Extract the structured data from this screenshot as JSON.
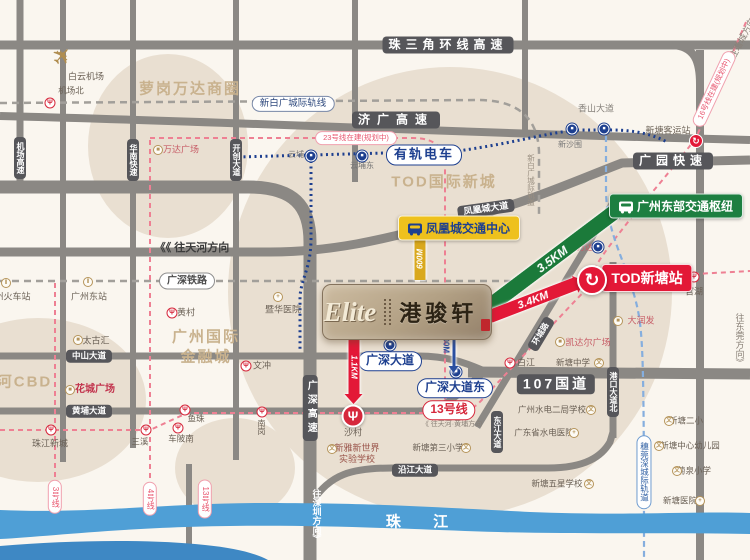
{
  "map": {
    "logo": {
      "en": "Elite",
      "cn": "港骏轩"
    },
    "river": {
      "label": "珠 江"
    },
    "zones": [
      {
        "n": "zone-luogang-wanda",
        "text": "萝岗万达商圈",
        "x": 190,
        "y": 89
      },
      {
        "n": "zone-tod-intl-newtown",
        "text": "TOD国际新城",
        "x": 444,
        "y": 182
      },
      {
        "n": "zone-gz-intl-finance-city",
        "text": "广州国际\n金融城",
        "x": 206,
        "y": 347
      },
      {
        "n": "zone-tianhe-cbd",
        "text": "天河CBD",
        "x": 16,
        "y": 382
      }
    ],
    "road_labels": [
      {
        "n": "road-zhusanjiao-ring-expwy",
        "text": "珠三角环线高速",
        "x": 448,
        "y": 45,
        "fs": 12,
        "ls": 5
      },
      {
        "n": "road-jiguang-expwy",
        "text": "济广高速",
        "x": 396,
        "y": 120,
        "fs": 12,
        "ls": 7
      },
      {
        "n": "road-guangyuan-expwy",
        "text": "广园快速",
        "x": 673,
        "y": 161,
        "fs": 12,
        "ls": 5
      },
      {
        "n": "road-g107",
        "text": "107国道",
        "x": 556,
        "y": 384,
        "fs": 14,
        "ls": 3
      },
      {
        "n": "road-fenghuangcheng-ave",
        "text": "凤凰城大道",
        "x": 486,
        "y": 209,
        "fs": 9,
        "rot": -8
      },
      {
        "n": "road-zhongshan-ave",
        "text": "中山大道",
        "x": 89,
        "y": 356,
        "fs": 8.5
      },
      {
        "n": "road-huangpu-ave",
        "text": "黄埔大道",
        "x": 89,
        "y": 411,
        "fs": 8.5
      },
      {
        "n": "road-yanjiang-ave",
        "text": "沿江大道",
        "x": 415,
        "y": 470,
        "fs": 8.5
      },
      {
        "n": "road-dongjiang-ave",
        "text": "东江大道",
        "x": 497,
        "y": 432,
        "fs": 8,
        "vert": 1
      },
      {
        "n": "road-gangkou-ave-north",
        "text": "港口大道北",
        "x": 613,
        "y": 392,
        "fs": 8,
        "vert": 1
      },
      {
        "n": "road-jichang-expwy",
        "text": "机场高速",
        "x": 20,
        "y": 158,
        "fs": 8,
        "vert": 1
      },
      {
        "n": "road-huanan-expwy",
        "text": "华南快速",
        "x": 133,
        "y": 160,
        "fs": 8,
        "vert": 1
      },
      {
        "n": "road-kaichuang-ave",
        "text": "开创大道",
        "x": 236,
        "y": 160,
        "fs": 8,
        "vert": 1
      },
      {
        "n": "road-guangshen-expwy",
        "text": "广深高速",
        "x": 310,
        "y": 408,
        "fs": 10,
        "vert": 1,
        "ls": 4
      },
      {
        "n": "road-huancheng-rd",
        "text": "环城路",
        "x": 541,
        "y": 334,
        "fs": 8,
        "rot": -59
      }
    ],
    "rail_pills": [
      {
        "n": "pill-guangshen-railway",
        "text": "广深铁路",
        "x": 187,
        "y": 281,
        "c": "#4a4a4a",
        "b": "#8e8e8e",
        "fs": 10,
        "bold": 1
      },
      {
        "n": "pill-xinbaiguang-intercity",
        "text": "新白广城际轨线",
        "x": 293,
        "y": 104,
        "c": "#2f4a7e",
        "b": "#7888a8",
        "fs": 9.5
      },
      {
        "n": "pill-tram",
        "text": "有轨电车",
        "x": 424,
        "y": 155,
        "c": "#1d3f8f",
        "b": "#1d3f8f",
        "fs": 13,
        "bold": 1,
        "ls": 2
      },
      {
        "n": "pill-line13",
        "text": "13号线",
        "x": 449,
        "y": 410,
        "c": "#d6283c",
        "b": "#d6283c",
        "fs": 12,
        "bold": 1
      },
      {
        "n": "pill-line23-planned",
        "text": "23号线在建(规划中)",
        "x": 356,
        "y": 138,
        "c": "#e8556e",
        "b": "#f0a0ae",
        "fs": 7.5
      },
      {
        "n": "pill-line16-planned",
        "text": "16号线在建(规划中)",
        "x": 714,
        "y": 89,
        "c": "#e8556e",
        "b": "#f0a0ae",
        "fs": 7.5,
        "rot": -65
      },
      {
        "n": "pill-line3",
        "text": "3号线",
        "x": 55,
        "y": 497,
        "c": "#e8556e",
        "b": "#f0a0ae",
        "fs": 8,
        "vert": 1
      },
      {
        "n": "pill-line4",
        "text": "4号线",
        "x": 150,
        "y": 499,
        "c": "#e8556e",
        "b": "#f0a0ae",
        "fs": 8,
        "vert": 1
      },
      {
        "n": "pill-line13-south",
        "text": "13号线",
        "x": 205,
        "y": 499,
        "c": "#e8556e",
        "b": "#f0a0ae",
        "fs": 8,
        "vert": 1
      },
      {
        "n": "pill-suiwanshen-intercity",
        "text": "穗莞深城际轨道",
        "x": 644,
        "y": 472,
        "c": "#2f5fa3",
        "b": "#6f9cd0",
        "fs": 8.5,
        "vert": 1
      },
      {
        "n": "pill-guangshen-ave",
        "text": "广深大道",
        "x": 390,
        "y": 361,
        "c": "#1d3f8f",
        "b": "#1d3f8f",
        "fs": 12,
        "bold": 1
      },
      {
        "n": "pill-guangshen-ave-east",
        "text": "广深大道东",
        "x": 455,
        "y": 388,
        "c": "#1d3f8f",
        "b": "#1d3f8f",
        "fs": 12,
        "bold": 1
      }
    ],
    "hubs": [
      {
        "n": "hub-fenghuangcheng-transport-center",
        "text": "凤凰城交通中心",
        "x": 459,
        "y": 228,
        "bg": "#eec11d",
        "c": "#1d3f8f",
        "bus": "blue",
        "fs": 12
      },
      {
        "n": "hub-gz-east-transport-hub",
        "text": "广州东部交通枢纽",
        "x": 676,
        "y": 206,
        "bg": "#1d7f41",
        "c": "#ffffff",
        "bus": "white",
        "fs": 12
      },
      {
        "n": "hub-tod-xintang-station",
        "text": "TOD新塘站",
        "x": 647,
        "y": 278,
        "bg": "#e31837",
        "c": "#ffffff",
        "fs": 14
      }
    ],
    "pois": [
      {
        "n": "poi-baiyun-airport",
        "text": "白云机场",
        "x": 86,
        "y": 77
      },
      {
        "n": "poi-jichangbei",
        "text": "机场北",
        "x": 71,
        "y": 91,
        "fs": 8.5
      },
      {
        "n": "poi-wanda-plaza",
        "text": "万达广场",
        "x": 181,
        "y": 150,
        "c": "#c75c66"
      },
      {
        "n": "poi-yunpu",
        "text": "云埔",
        "x": 296,
        "y": 155,
        "fs": 8,
        "c": "#777777"
      },
      {
        "n": "poi-yunpudong",
        "text": "云埔东",
        "x": 362,
        "y": 166,
        "fs": 8,
        "c": "#777777"
      },
      {
        "n": "poi-xinshawei",
        "text": "新沙围",
        "x": 570,
        "y": 145,
        "fs": 8,
        "c": "#777777"
      },
      {
        "n": "poi-xintang-bus-terminal",
        "text": "新塘客运站",
        "x": 668,
        "y": 131
      },
      {
        "n": "poi-guanhu",
        "text": "官湖",
        "x": 694,
        "y": 292
      },
      {
        "n": "poi-jihua-hospital",
        "text": "暨华医院",
        "x": 283,
        "y": 310
      },
      {
        "n": "poi-huangcun",
        "text": "黄村",
        "x": 186,
        "y": 313
      },
      {
        "n": "poi-taikoo-hui",
        "text": "太古汇",
        "x": 96,
        "y": 341
      },
      {
        "n": "poi-huacheng-square",
        "text": "花城广场",
        "x": 95,
        "y": 390,
        "c": "#c2334d",
        "fs": 10,
        "bold": 1
      },
      {
        "n": "poi-wenchong",
        "text": "文冲",
        "x": 262,
        "y": 366
      },
      {
        "n": "poi-zhujiang-newtown",
        "text": "珠江新城",
        "x": 50,
        "y": 444
      },
      {
        "n": "poi-sanxi",
        "text": "三溪",
        "x": 140,
        "y": 442,
        "fs": 8.5
      },
      {
        "n": "poi-chebeinan",
        "text": "车陂南",
        "x": 181,
        "y": 439,
        "fs": 8.5
      },
      {
        "n": "poi-yuzhu",
        "text": "鱼珠",
        "x": 196,
        "y": 419,
        "fs": 8.5
      },
      {
        "n": "poi-nangang",
        "text": "南岗",
        "x": 261,
        "y": 427,
        "fs": 8,
        "vert": 1
      },
      {
        "n": "poi-shacun",
        "text": "沙村",
        "x": 353,
        "y": 433
      },
      {
        "n": "poi-baijiang",
        "text": "白江",
        "x": 526,
        "y": 363
      },
      {
        "n": "poi-xintang-wanda",
        "text": "新塘万达",
        "x": 577,
        "y": 248,
        "fs": 8,
        "c": "#c75c66"
      },
      {
        "n": "poi-rt-mart",
        "text": "大润发",
        "x": 641,
        "y": 321,
        "c": "#c75c66"
      },
      {
        "n": "poi-kaidaer-plaza",
        "text": "凯达尔广场",
        "x": 588,
        "y": 343,
        "c": "#c75c66"
      },
      {
        "n": "poi-xintang-middle-school",
        "text": "新塘中学",
        "x": 573,
        "y": 363,
        "fs": 8.5
      },
      {
        "n": "poi-gz-shuidian-erju-school",
        "text": "广州水电二局学校",
        "x": 552,
        "y": 410,
        "fs": 8.5
      },
      {
        "n": "poi-guangdong-shuidian-hospital",
        "text": "广东省水电医院",
        "x": 544,
        "y": 433,
        "fs": 8.5
      },
      {
        "n": "poi-xintang-wuxing-school",
        "text": "新塘五星学校",
        "x": 557,
        "y": 484,
        "fs": 8.5
      },
      {
        "n": "poi-xintang-no2-primary",
        "text": "新塘二小",
        "x": 686,
        "y": 421,
        "fs": 8.5
      },
      {
        "n": "poi-xintang-kindergarten",
        "text": "新塘中心幼儿园",
        "x": 690,
        "y": 446,
        "fs": 8.5
      },
      {
        "n": "poi-juquan-primary",
        "text": "菊泉小学",
        "x": 694,
        "y": 471,
        "fs": 8.5
      },
      {
        "n": "poi-xintang-hospital",
        "text": "新塘医院",
        "x": 680,
        "y": 501,
        "fs": 8.5
      },
      {
        "n": "poi-xintang-no3-primary",
        "text": "新塘第三小学",
        "x": 438,
        "y": 448,
        "fs": 8.5
      },
      {
        "n": "poi-xinya-new-world-school",
        "text": "新雅新世界\n实验学校",
        "x": 357,
        "y": 454,
        "c": "#9a544a"
      },
      {
        "n": "poi-gz-east-station",
        "text": "广州东站",
        "x": 89,
        "y": 297
      },
      {
        "n": "poi-gz-railway-station",
        "text": "广州火车站",
        "x": 8,
        "y": 297
      }
    ],
    "gtexts": [
      {
        "n": "dir-to-tianhe",
        "text": "《《 往天河方向",
        "x": 192,
        "y": 247,
        "fs": 11,
        "c": "#3c3c3c",
        "bold": 1
      },
      {
        "n": "note-line13-direction",
        "text": "《 往天河·黄埔方向",
        "x": 452,
        "y": 424,
        "fs": 7
      },
      {
        "n": "dir-to-dongguan",
        "text": "往东莞方向》",
        "x": 740,
        "y": 340,
        "fs": 9,
        "vert": 1
      },
      {
        "n": "dir-to-zengcheng",
        "text": "往增城方向",
        "x": 742,
        "y": 38,
        "fs": 9,
        "rot": -62
      },
      {
        "n": "dir-to-shenzhen",
        "text": "往深圳方向》",
        "x": 317,
        "y": 516,
        "fs": 9,
        "c": "#ffffff",
        "vert": 1,
        "bold": 1
      },
      {
        "n": "road-xiangshan-ave",
        "text": "香山大道",
        "x": 596,
        "y": 108,
        "fs": 9,
        "c": "#86817b"
      },
      {
        "n": "note-xinbaiguang-rail",
        "text": "新白广城际轨道",
        "x": 531,
        "y": 180,
        "fs": 7.5,
        "c": "#9b9082",
        "vert": 1
      },
      {
        "n": "label-500m",
        "text": "500M",
        "x": 446,
        "y": 343,
        "fs": 8,
        "c": "#2b4fa0",
        "rot": 90,
        "bold": 1
      }
    ],
    "icons": [
      {
        "n": "airplane-icon",
        "k": "plane",
        "x": 63,
        "y": 57,
        "s": 24,
        "rot": -48
      },
      {
        "n": "wanda-plaza-icon",
        "k": "building",
        "x": 158,
        "y": 150
      },
      {
        "n": "jihua-hospital-icon",
        "k": "hospital",
        "x": 278,
        "y": 297
      },
      {
        "n": "taikoo-hui-icon",
        "k": "building",
        "x": 78,
        "y": 340
      },
      {
        "n": "huacheng-square-icon",
        "k": "building",
        "x": 70,
        "y": 390
      },
      {
        "n": "rt-mart-icon",
        "k": "building",
        "x": 618,
        "y": 321
      },
      {
        "n": "kaidaer-plaza-icon",
        "k": "building",
        "x": 560,
        "y": 342
      },
      {
        "n": "xintang-middle-school-icon",
        "k": "school",
        "x": 599,
        "y": 363
      },
      {
        "n": "shuidian-erju-school-icon",
        "k": "school",
        "x": 591,
        "y": 410
      },
      {
        "n": "shuidian-hospital-icon",
        "k": "hospital",
        "x": 574,
        "y": 433
      },
      {
        "n": "wuxing-school-icon",
        "k": "school",
        "x": 589,
        "y": 484
      },
      {
        "n": "xintang-no2-primary-icon",
        "k": "school",
        "x": 669,
        "y": 421
      },
      {
        "n": "kindergarten-icon",
        "k": "school",
        "x": 659,
        "y": 446
      },
      {
        "n": "juquan-primary-icon",
        "k": "school",
        "x": 677,
        "y": 471
      },
      {
        "n": "xintang-hospital-icon",
        "k": "hospital",
        "x": 700,
        "y": 501
      },
      {
        "n": "xintang-no3-primary-icon",
        "k": "school",
        "x": 466,
        "y": 448
      },
      {
        "n": "xinya-school-icon",
        "k": "school",
        "x": 332,
        "y": 449
      },
      {
        "n": "gz-east-station-icon",
        "k": "train",
        "x": 88,
        "y": 282
      },
      {
        "n": "gz-railway-station-icon",
        "k": "train",
        "x": 6,
        "y": 283
      }
    ],
    "stations": [
      {
        "n": "station-jichangbei",
        "k": "metro",
        "x": 50,
        "y": 103
      },
      {
        "n": "station-huangcun",
        "k": "metro",
        "x": 172,
        "y": 313
      },
      {
        "n": "station-zhujiang-newtown",
        "k": "metro",
        "x": 51,
        "y": 430
      },
      {
        "n": "station-sanxi",
        "k": "metro",
        "x": 146,
        "y": 430
      },
      {
        "n": "station-chebeinan",
        "k": "metro",
        "x": 178,
        "y": 428
      },
      {
        "n": "station-yuzhu",
        "k": "metro",
        "x": 185,
        "y": 410
      },
      {
        "n": "station-nangang",
        "k": "metro",
        "x": 262,
        "y": 412
      },
      {
        "n": "station-baijiang",
        "k": "metro",
        "x": 510,
        "y": 363
      },
      {
        "n": "station-guanhu",
        "k": "metro",
        "x": 694,
        "y": 277
      },
      {
        "n": "station-wenchong",
        "k": "metro",
        "x": 246,
        "y": 366
      },
      {
        "n": "station-shacun",
        "k": "metro-big",
        "x": 353,
        "y": 416
      },
      {
        "n": "tram-stop-yunpu",
        "k": "tram",
        "x": 311,
        "y": 156
      },
      {
        "n": "tram-stop-yunpudong",
        "k": "tram",
        "x": 362,
        "y": 156
      },
      {
        "n": "tram-stop-west",
        "k": "tram",
        "x": 572,
        "y": 129
      },
      {
        "n": "tram-stop-east",
        "k": "tram",
        "x": 604,
        "y": 129
      },
      {
        "n": "station-xintang-wanda",
        "k": "tram",
        "x": 598,
        "y": 247
      },
      {
        "n": "stop-guangshen-ave",
        "k": "tram",
        "x": 390,
        "y": 345
      },
      {
        "n": "stop-guangshen-ave-east",
        "k": "tram",
        "x": 456,
        "y": 372
      },
      {
        "n": "xintang-bus-terminal-icon",
        "k": "swoosh",
        "x": 696,
        "y": 141
      },
      {
        "n": "tod-xintang-station-icon",
        "k": "swoosh-big",
        "x": 592,
        "y": 280
      }
    ],
    "arrows": [
      {
        "n": "arrow-3-5km",
        "label": "3.5KM",
        "x": 552,
        "y": 259,
        "len": 158,
        "th": 15,
        "rot": -37,
        "bg": "#1b7a3a",
        "fs": 12
      },
      {
        "n": "arrow-3-4km",
        "label": "3.4KM",
        "x": 533,
        "y": 300,
        "len": 92,
        "th": 13,
        "rot": -21,
        "bg": "#e31837",
        "fs": 11
      },
      {
        "n": "arrow-1-1km",
        "label": "1.1KM",
        "x": 354,
        "y": 367,
        "len": 56,
        "th": 11,
        "rot": 90,
        "bg": "#e31837",
        "fs": 8
      },
      {
        "n": "arrow-600m",
        "label": "600M",
        "x": 420,
        "y": 259,
        "len": 42,
        "th": 11,
        "rot": -90,
        "bg": "#d9a81d",
        "fs": 8
      },
      {
        "n": "arrow-500m",
        "label": "",
        "x": 454,
        "y": 350,
        "len": 32,
        "th": 3,
        "rot": 90,
        "bg": "#2b4fa0",
        "fs": 0
      }
    ]
  }
}
